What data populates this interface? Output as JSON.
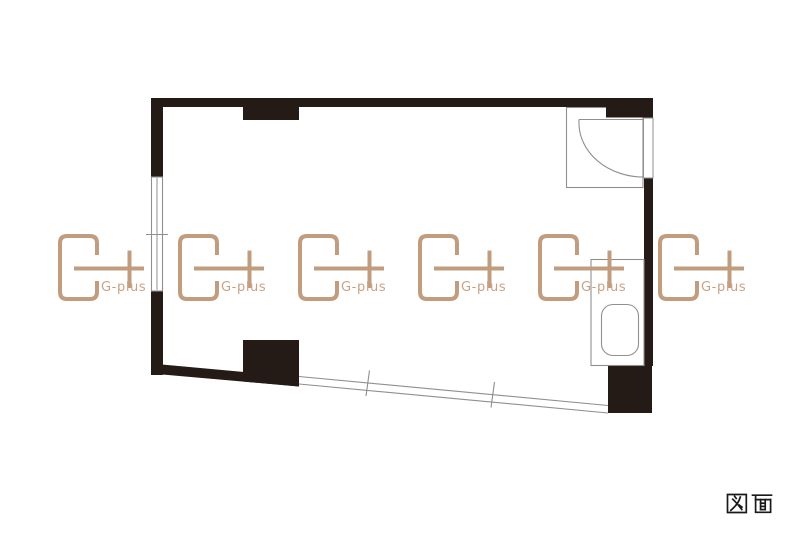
{
  "canvas": {
    "width": 800,
    "height": 534,
    "background": "#ffffff"
  },
  "floor_plan": {
    "wall_color": "#241a16",
    "line_color": "#8f8f8f",
    "elements": [
      "entrance-door",
      "toilet",
      "left-sliding-window",
      "bottom-sliding-window",
      "wall-pillars"
    ]
  },
  "watermark": {
    "label": "G-plus",
    "color": "#c29c7e",
    "text_color": "#c8a287",
    "positions_x": [
      60,
      180,
      300,
      420,
      540,
      660
    ],
    "position_y": 236
  },
  "caption": {
    "label": "図面",
    "color": "#1a1a1a"
  }
}
